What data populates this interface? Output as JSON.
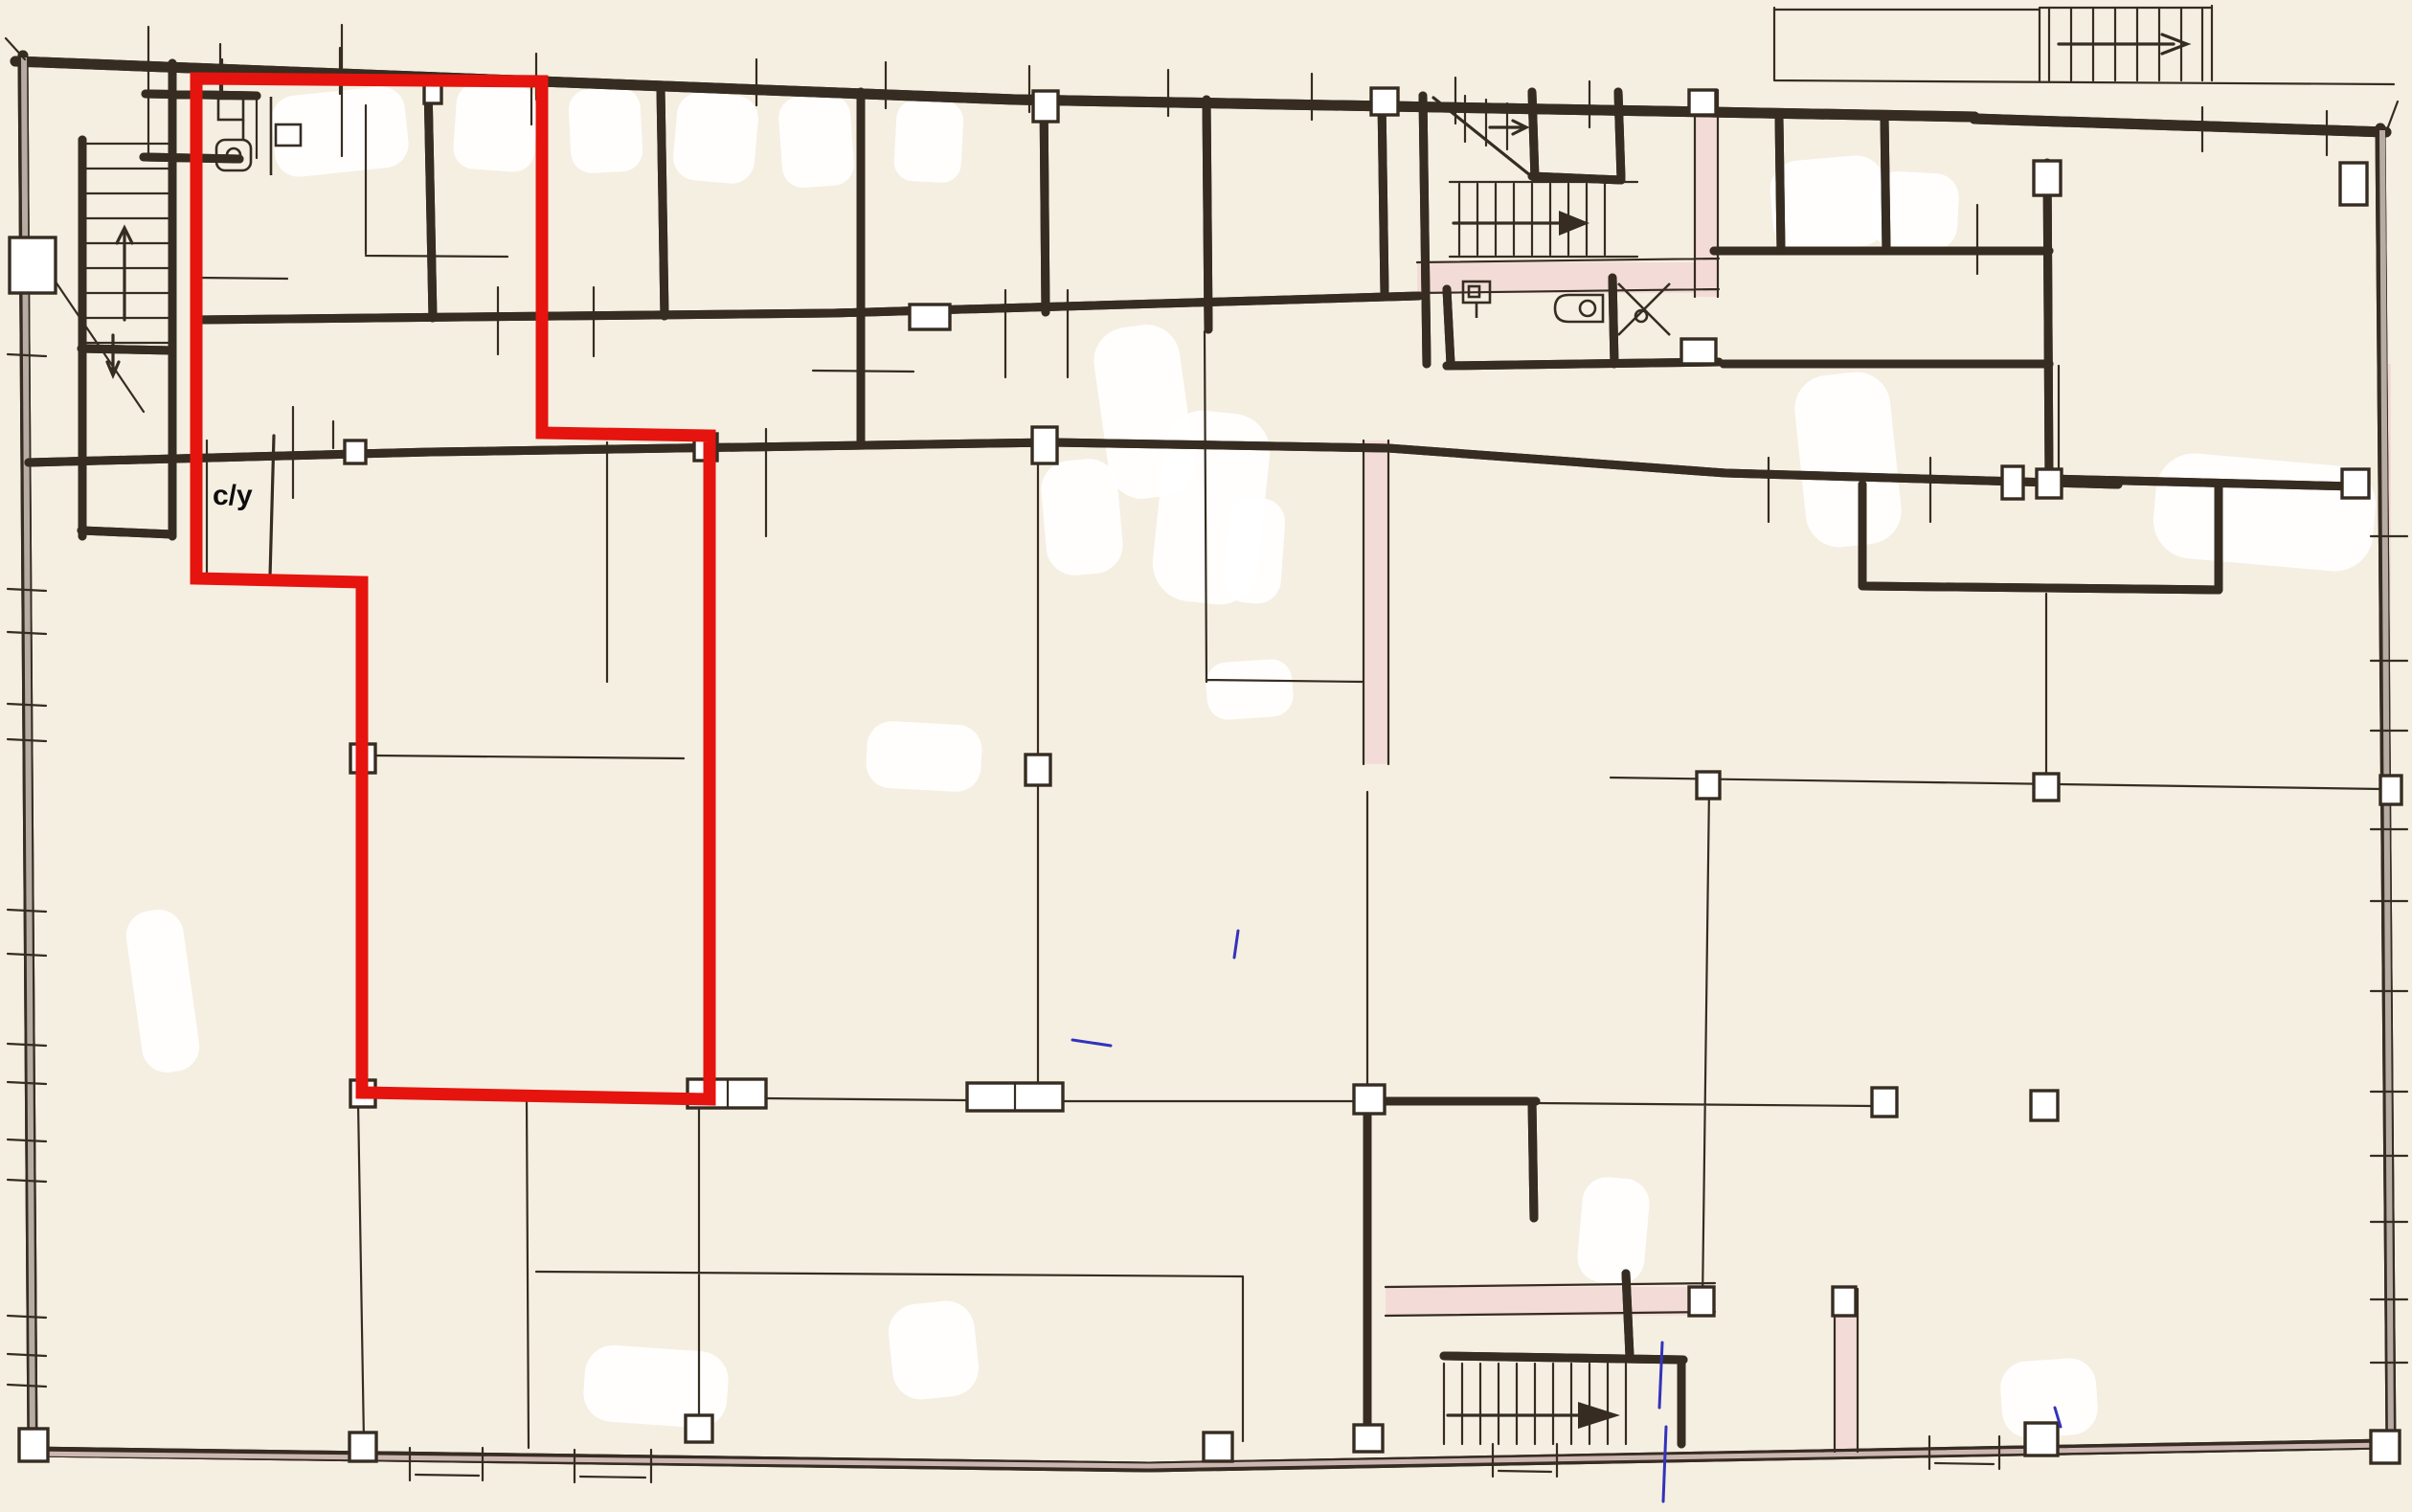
{
  "document": {
    "kind": "scanned hand-drawn floor plan",
    "only_text": "с/у"
  },
  "colors": {
    "paper": "#f5efe2",
    "ink": "#362c21",
    "red": "#e5140e",
    "pink": "#f3d9d7",
    "blue": "#3333bb",
    "wall_gray": "#cdc3bb"
  },
  "label": {
    "text": "с/у",
    "x": "222",
    "y": "527"
  },
  "red_area": {
    "description": "red outline highlighting a unit incl. small bathroom room",
    "points_str": "205,82 566,85 566,452 741,455 741,1148 378,1141 378,608 205,604"
  },
  "features": {
    "stairs": [
      {
        "id": "stair-top-left",
        "arrow": "up"
      },
      {
        "id": "stair-top-left-lower",
        "arrow": "down"
      },
      {
        "id": "stair-top-middle",
        "arrow": "right"
      },
      {
        "id": "stair-top-right-exterior",
        "arrow": "right"
      },
      {
        "id": "stair-bottom-middle",
        "arrow": "right"
      }
    ],
    "fixtures": [
      "toilet",
      "washbasin",
      "toilet",
      "bathtub",
      "shower"
    ],
    "columns": "small square column marks on structural grid",
    "windows": "tick marks along exterior walls"
  }
}
